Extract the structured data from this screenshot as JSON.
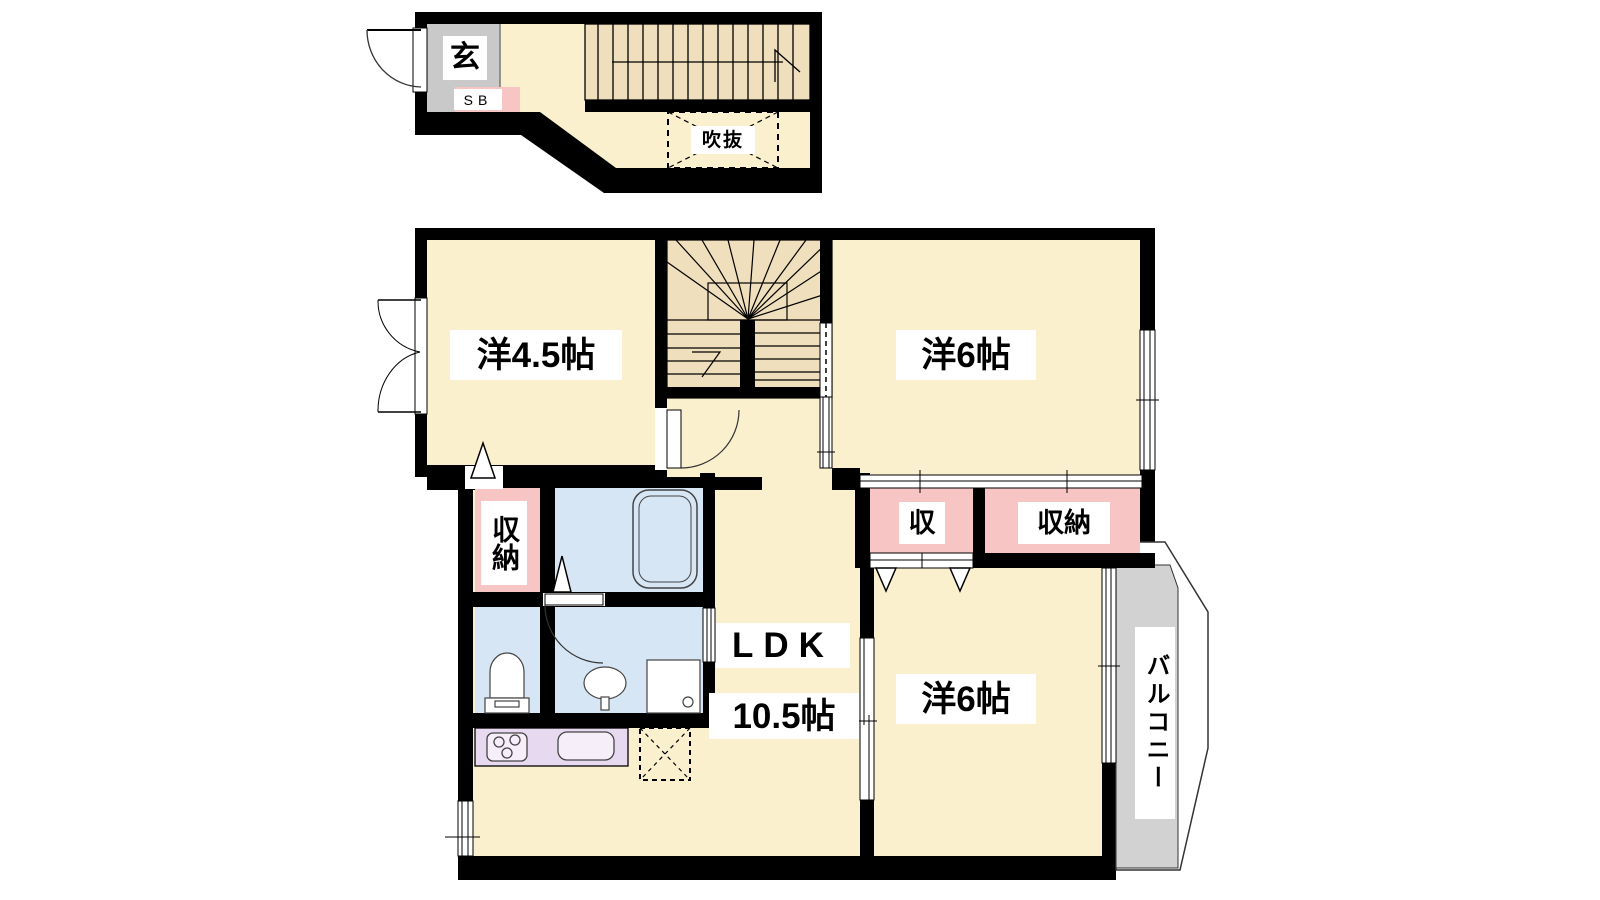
{
  "labels": {
    "entrance": "玄",
    "shoe_box": "SB",
    "void": "吹抜",
    "room_45": "洋4.5帖",
    "room_6_top": "洋6帖",
    "closet_left": "収納",
    "closet_small": "収",
    "closet_right": "収納",
    "ldk": "LDK",
    "ldk_size": "10.5帖",
    "room_6_bottom": "洋6帖",
    "balcony": "バルコニー"
  },
  "colors": {
    "background": "#FFFFFF",
    "wall": "#000000",
    "floor": "#FAF0CE",
    "stairs": "#EFDFBD",
    "closet_pink": "#F8C5C5",
    "wet_area_blue": "#D7E6F5",
    "kitchen_lavender": "#E7D9F0",
    "entrance_gray": "#C9C9C9",
    "balcony_gray": "#D2D2D2",
    "fixture_outline": "#444444"
  }
}
